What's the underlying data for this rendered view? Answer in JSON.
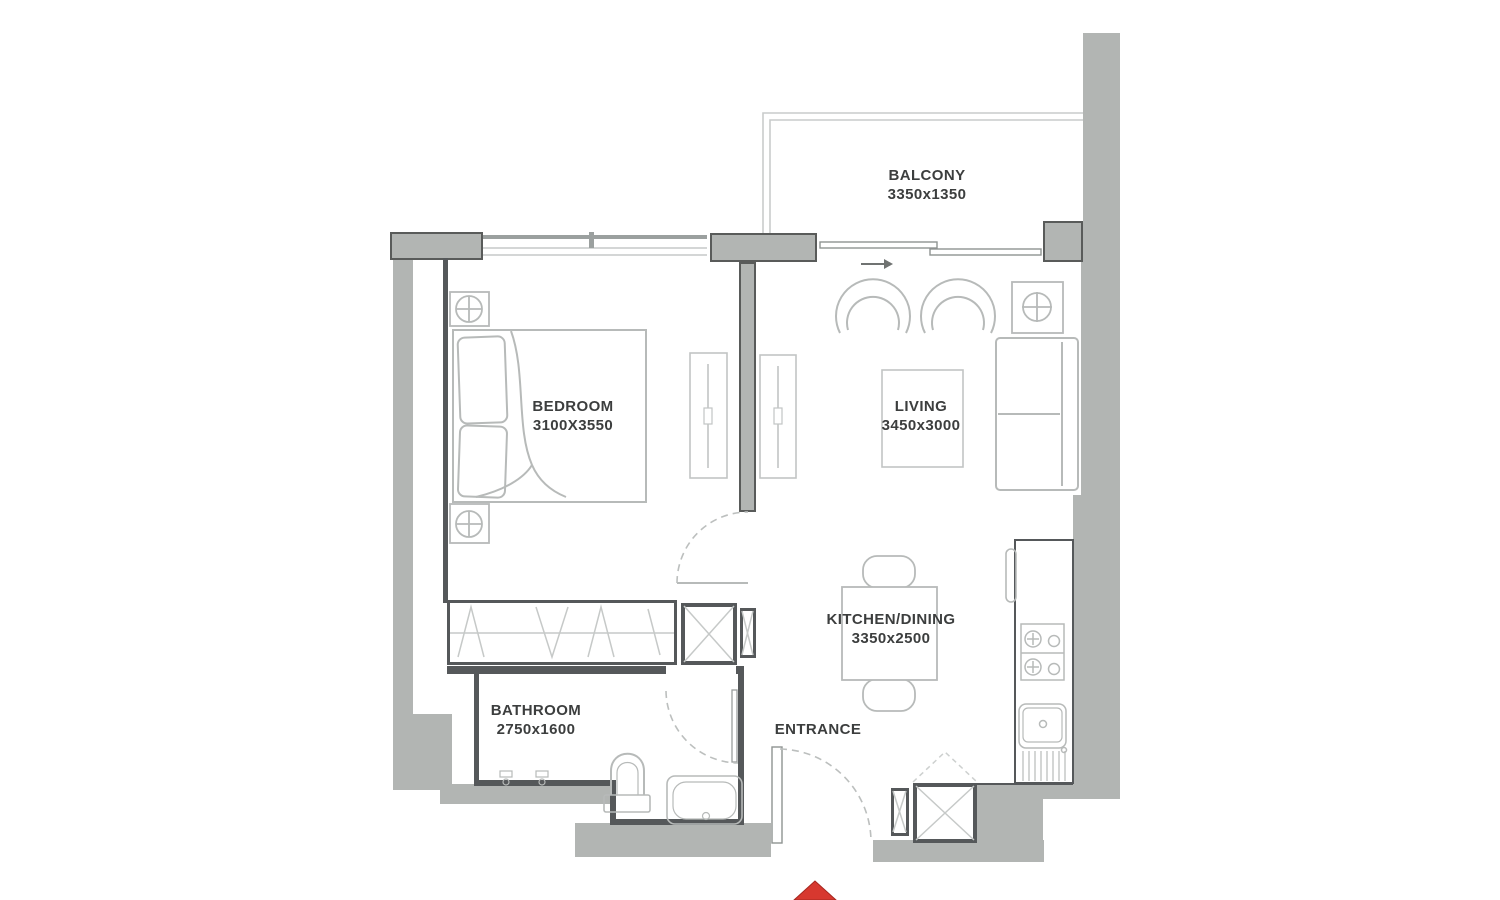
{
  "page": {
    "title": "Apartment Floor Plan",
    "type": "1 Bedroom Unit"
  },
  "colors": {
    "wall_fill": "#b2b5b3",
    "wall_dark": "#55585a",
    "furniture_line": "#b7bab9",
    "balcony_line": "#c9cccb",
    "text": "#3c3e3e",
    "entrance_arrow_red": "#d7382f"
  },
  "rooms": [
    {
      "id": "balcony",
      "label": "BALCONY",
      "dims": "3350x1350"
    },
    {
      "id": "bedroom",
      "label": "BEDROOM",
      "dims": "3100X3550"
    },
    {
      "id": "living",
      "label": "LIVING",
      "dims": "3450x3000"
    },
    {
      "id": "kitchen_dining",
      "label": "KITCHEN/DINING",
      "dims": "3350x2500"
    },
    {
      "id": "bathroom",
      "label": "BATHROOM",
      "dims": "2750x1600"
    },
    {
      "id": "entrance",
      "label": "ENTRANCE",
      "dims": ""
    }
  ]
}
